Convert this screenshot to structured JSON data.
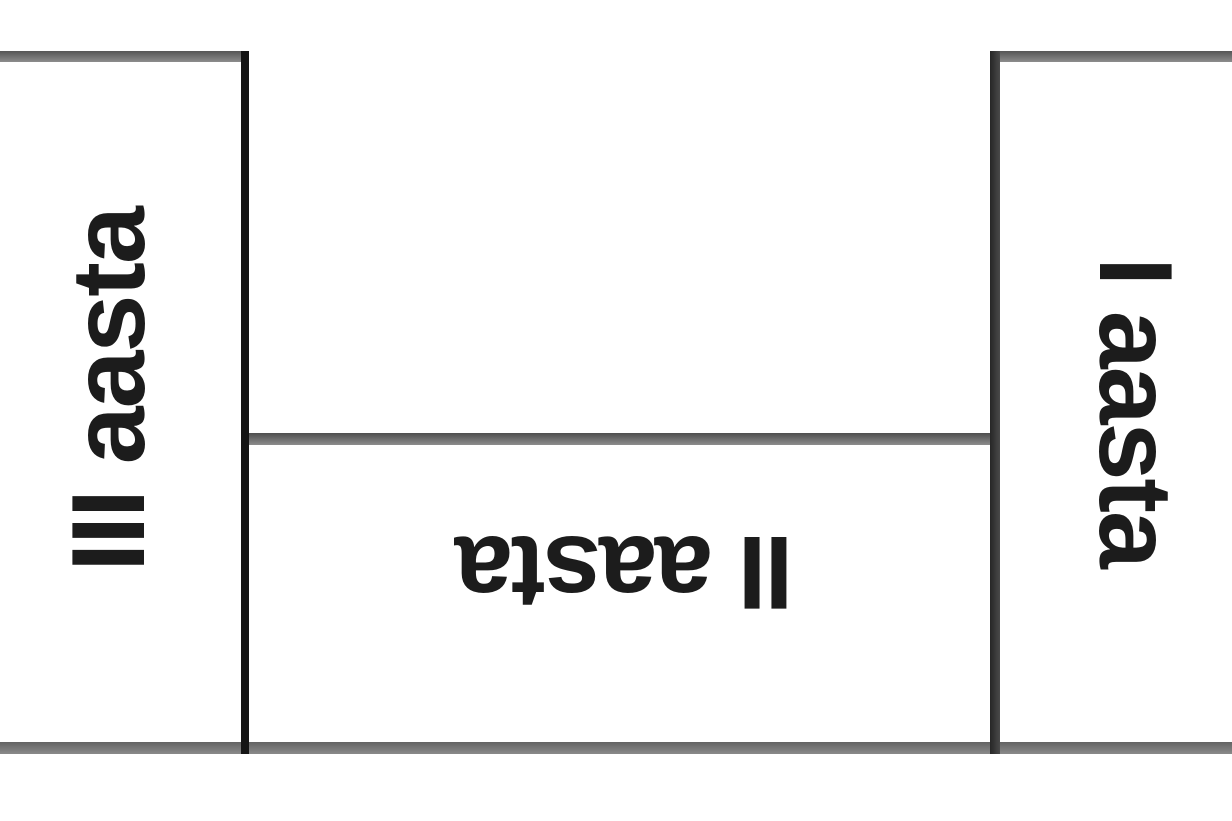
{
  "diagram": {
    "regions": [
      {
        "id": "year3",
        "label": "III aasta",
        "position": "left",
        "text_orientation": "rotated-270"
      },
      {
        "id": "year2",
        "label": "II aasta",
        "position": "middle",
        "text_orientation": "rotated-180"
      },
      {
        "id": "year1",
        "label": "I aasta",
        "position": "right",
        "text_orientation": "rotated-90"
      }
    ],
    "colors": {
      "background": "#ffffff",
      "text": "#1c1c1c",
      "gray_rule": "#6d6d6d",
      "black_rule": "#141414"
    }
  }
}
